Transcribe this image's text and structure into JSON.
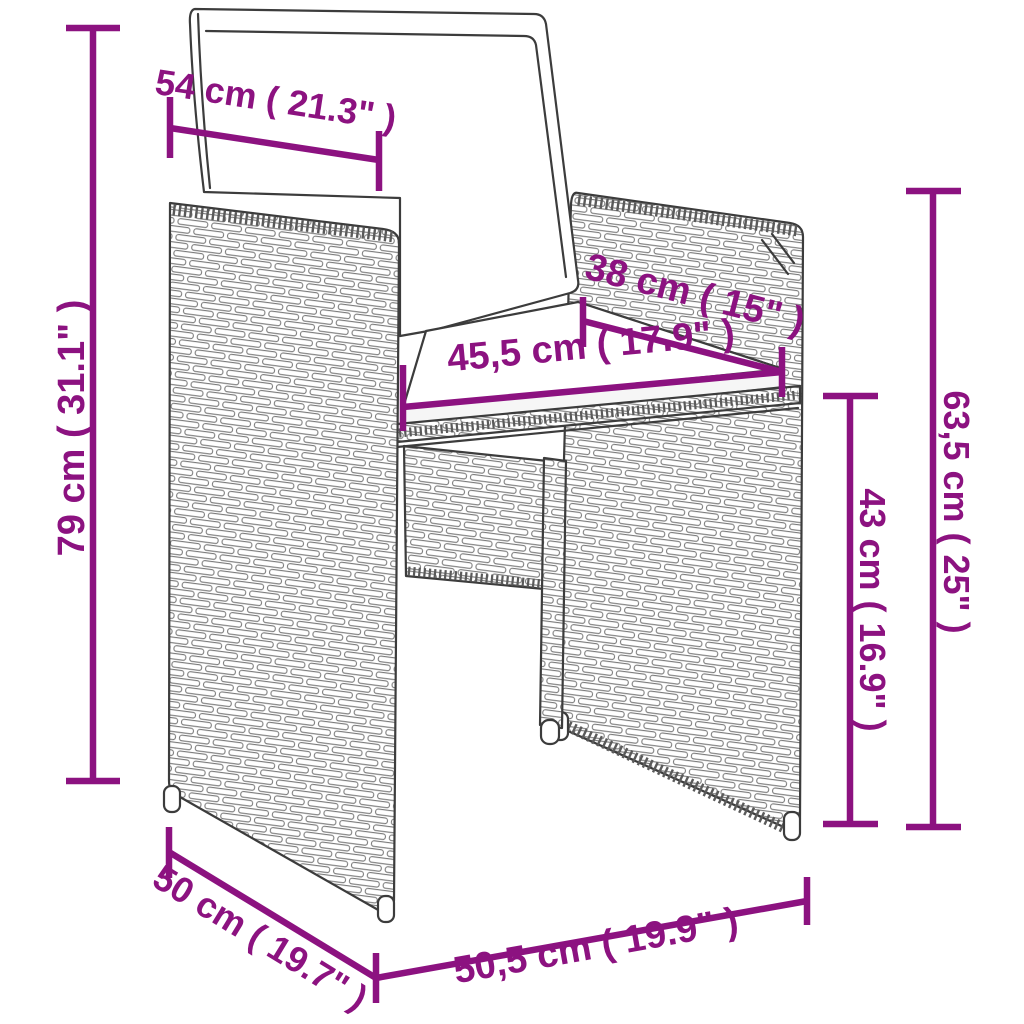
{
  "colors": {
    "accent": "#8C1280",
    "chair_outline": "#3C3C3C"
  },
  "dimensions": {
    "top_width": {
      "label": "54 cm ( 21.3\" )"
    },
    "total_height": {
      "label": "79 cm ( 31.1\" )"
    },
    "backrest_depth": {
      "label": "38 cm ( 15\" )"
    },
    "seat_width": {
      "label": "45,5 cm ( 17.9\" )"
    },
    "seat_height": {
      "label": "43 cm ( 16.9\" )"
    },
    "armrest_height": {
      "label": "63,5 cm ( 25\" )"
    },
    "side_depth": {
      "label": "50 cm ( 19.7\" )"
    },
    "front_base_width": {
      "label": "50,5 cm ( 19.9\" )"
    }
  }
}
